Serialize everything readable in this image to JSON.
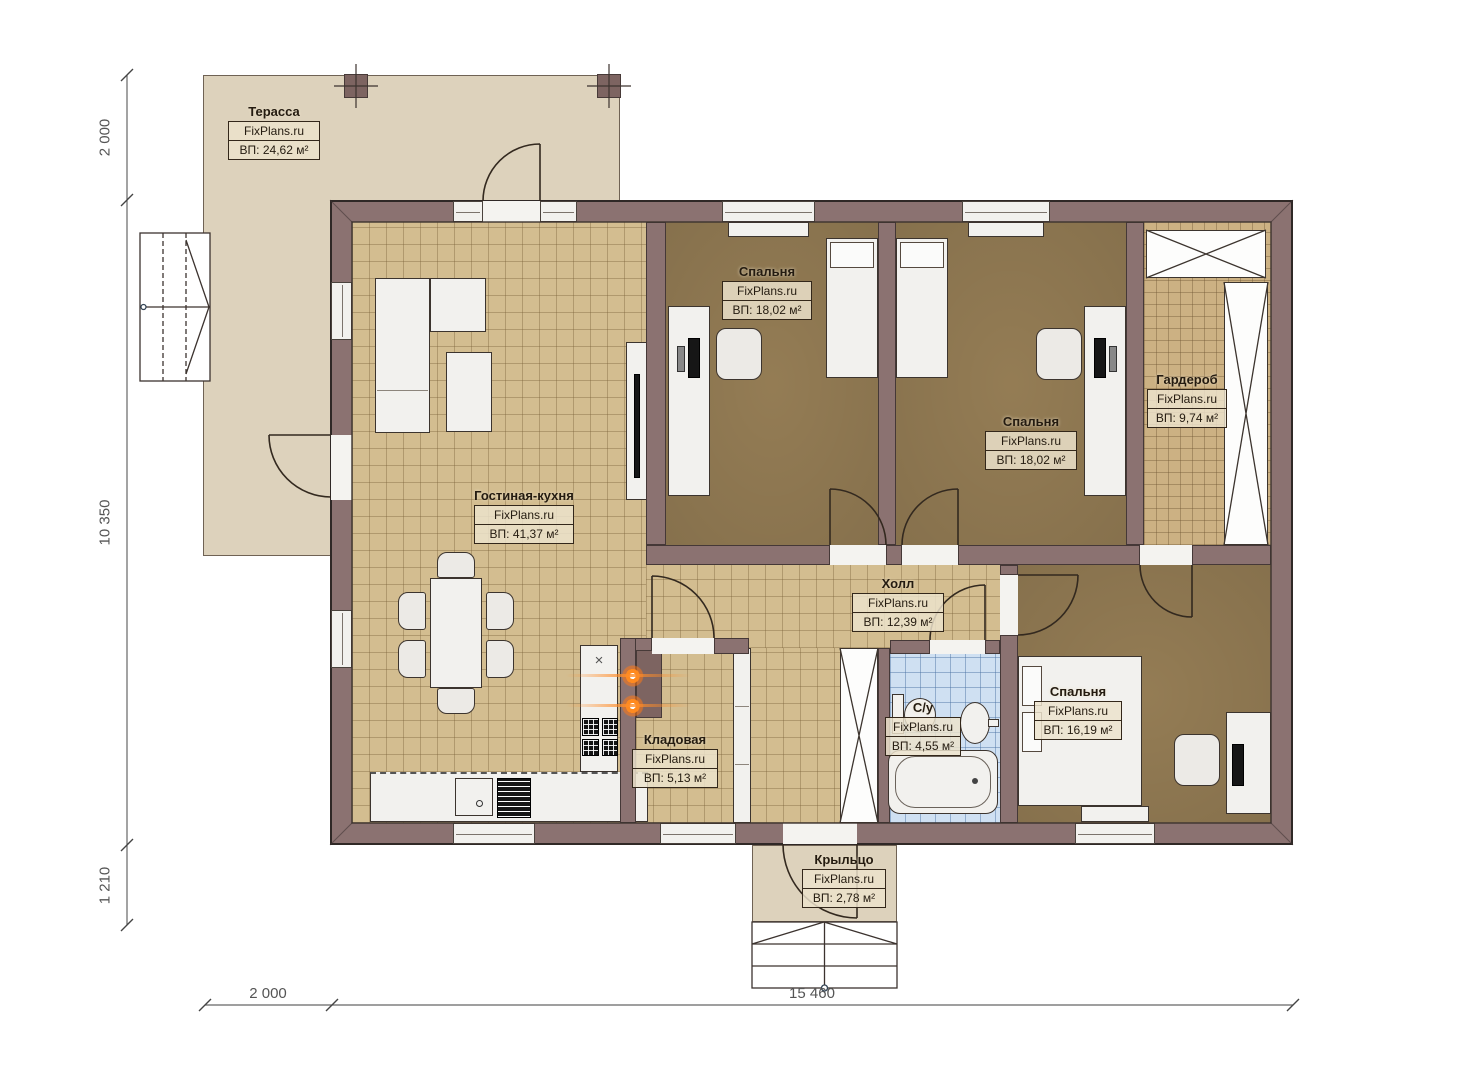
{
  "brand": "FixPlans.ru",
  "rooms": [
    {
      "id": "terrace",
      "name": "Терасса",
      "area": "ВП: 24,62 м²"
    },
    {
      "id": "living-kitchen",
      "name": "Гостиная-кухня",
      "area": "ВП: 41,37 м²"
    },
    {
      "id": "bedroom-1",
      "name": "Спальня",
      "area": "ВП: 18,02 м²"
    },
    {
      "id": "bedroom-2",
      "name": "Спальня",
      "area": "ВП: 18,02 м²"
    },
    {
      "id": "wardrobe",
      "name": "Гардероб",
      "area": "ВП: 9,74 м²"
    },
    {
      "id": "hall",
      "name": "Холл",
      "area": "ВП: 12,39 м²"
    },
    {
      "id": "pantry",
      "name": "Кладовая",
      "area": "ВП: 5,13 м²"
    },
    {
      "id": "bathroom",
      "name": "С/у",
      "area": "ВП: 4,55 м²"
    },
    {
      "id": "bedroom-3",
      "name": "Спальня",
      "area": "ВП: 16,19 м²"
    },
    {
      "id": "porch",
      "name": "Крыльцо",
      "area": "ВП: 2,78 м²"
    }
  ],
  "dimensions": {
    "left_top": "2 000",
    "left_height": "10 350",
    "left_bottom": "1 210",
    "bottom_left": "2 000",
    "bottom_width": "15 460"
  },
  "colors": {
    "wall": "#8b7271",
    "terrace_floor": "#ddd2bc",
    "tile_floor": "#d3bd90",
    "carpet": "#9c8359",
    "bath_tile": "#cfe0f2",
    "burner_accent": "#ff7b1f"
  }
}
